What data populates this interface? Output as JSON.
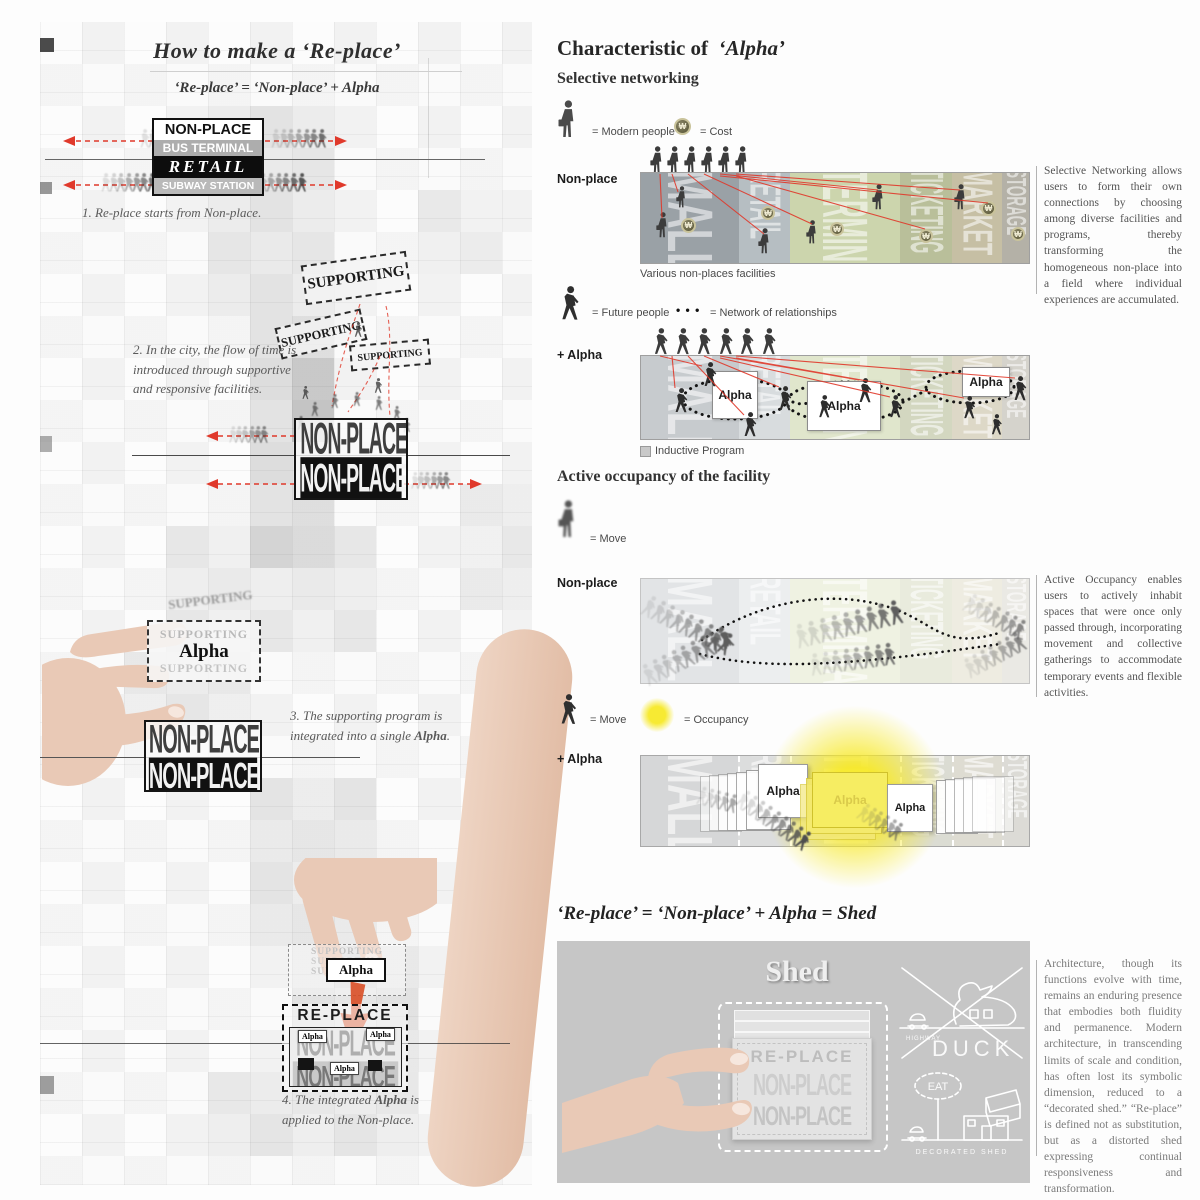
{
  "colors": {
    "accent_red": "#e0392b",
    "occupancy_yellow": "#f5e93d",
    "panel_mall": "#9aa1a6",
    "panel_retail": "#b6bec2",
    "panel_terminal": "#ccd5ad",
    "panel_ticketing": "#b9bf9a",
    "panel_market": "#c6bfa4",
    "panel_storage": "#b4b1a7",
    "shed_panel_gray": "#c6c6c6"
  },
  "left": {
    "title": "How to  make a ‘Re-place’",
    "subtitle": "‘Re-place’ = ‘Non-place’ + Alpha",
    "step1": {
      "line1": "NON-PLACE",
      "line2": "BUS TERMINAL",
      "line3": "RETAIL",
      "line4": "SUBWAY STATION",
      "caption": "1. Re-place starts from Non-place."
    },
    "step2": {
      "sup1": "SUPPORTING",
      "sup2": "SUPPORTING",
      "sup3": "SUPPORTING",
      "caption_l1": "2. In the city, the flow of time is",
      "caption_l2": "introduced through supportive",
      "caption_l3": "and responsive facilities.",
      "box_top": "NON-PLACE",
      "box_bottom": "NON-PLACE"
    },
    "step3": {
      "sup_ghost": "SUPPORTING",
      "sup_top": "SUPPORTING",
      "alpha": "Alpha",
      "sup_bottom": "SUPPORTING",
      "caption_a": "3. The supporting program is",
      "caption_b1": "integrated into a single ",
      "caption_b2": "Alpha",
      "caption_b3": ".",
      "box_top": "NON-PLACE",
      "box_bottom": "NON-PLACE"
    },
    "step4": {
      "sup_ghost1": "SUPPORTING",
      "sup_ghost2": "SUPPORTING",
      "sup_ghost3": "SUPPORTING",
      "alpha": "Alpha",
      "replace": "RE-PLACE",
      "box_top": "NON-PLACE",
      "box_bottom": "NON-PLACE",
      "mini1": "Alpha",
      "mini2": "Alpha",
      "mini3": "Alpha",
      "caption_a1": "4. The integrated ",
      "caption_a2": "Alpha",
      "caption_a3": " is",
      "caption_b": "applied to the Non-place."
    }
  },
  "right": {
    "header_prefix": "Characteristic of",
    "header_alpha": "‘Alpha’",
    "selective": {
      "heading": "Selective  networking",
      "legend_modern": "= Modern people",
      "legend_cost": "= Cost",
      "cost_symbol": "₩",
      "row1_label": "Non-place",
      "facilities": [
        "MALL",
        "RETAIL",
        "TERMINAL",
        "TICKETING",
        "MARKET",
        "STORAGE"
      ],
      "caption": "Various non-places facilities",
      "legend_future": "= Future people",
      "legend_network": "= Network of relationships",
      "network_dots": "• • •",
      "row2_label": "+ Alpha",
      "alpha_box": "Alpha",
      "inductive": "Inductive Program",
      "paragraph": "Selective Networking allows users to form their own connections by choosing among diverse facilities and programs, thereby transforming the homogeneous non-place into a field where individual experiences are accumulated."
    },
    "occupancy": {
      "heading": "Active occupancy of the facility",
      "legend_move": "= Move",
      "row1_label": "Non-place",
      "legend_move2": "= Move",
      "legend_occupancy": "= Occupancy",
      "row2_label": "+ Alpha",
      "alpha_box": "Alpha",
      "paragraph": "Active Occupancy enables users to actively inhabit spaces that were once only passed through, incorporating movement and collective gatherings to accommodate temporary events and flexible activities."
    },
    "shed": {
      "heading_eq": "‘Re-place’ = ‘Non-place’ + Alpha = ",
      "heading_bold": "Shed",
      "panel_title": "Shed",
      "ghost_replace": "RE-PLACE",
      "duck_label": "DUCK",
      "highway_label": "HIGHWAY",
      "eat_label": "EAT",
      "decorated_label": "DECORATED SHED",
      "paragraph": "Architecture, though its functions evolve with time, remains an enduring presence that embodies both fluidity and permanence. Modern architecture, in transcending limits of scale and condition, has often lost its symbolic dimension, reduced to a “decorated shed.” “Re-place” is defined not as substitution, but as a distorted shed expressing continual responsiveness and transformation."
    }
  }
}
